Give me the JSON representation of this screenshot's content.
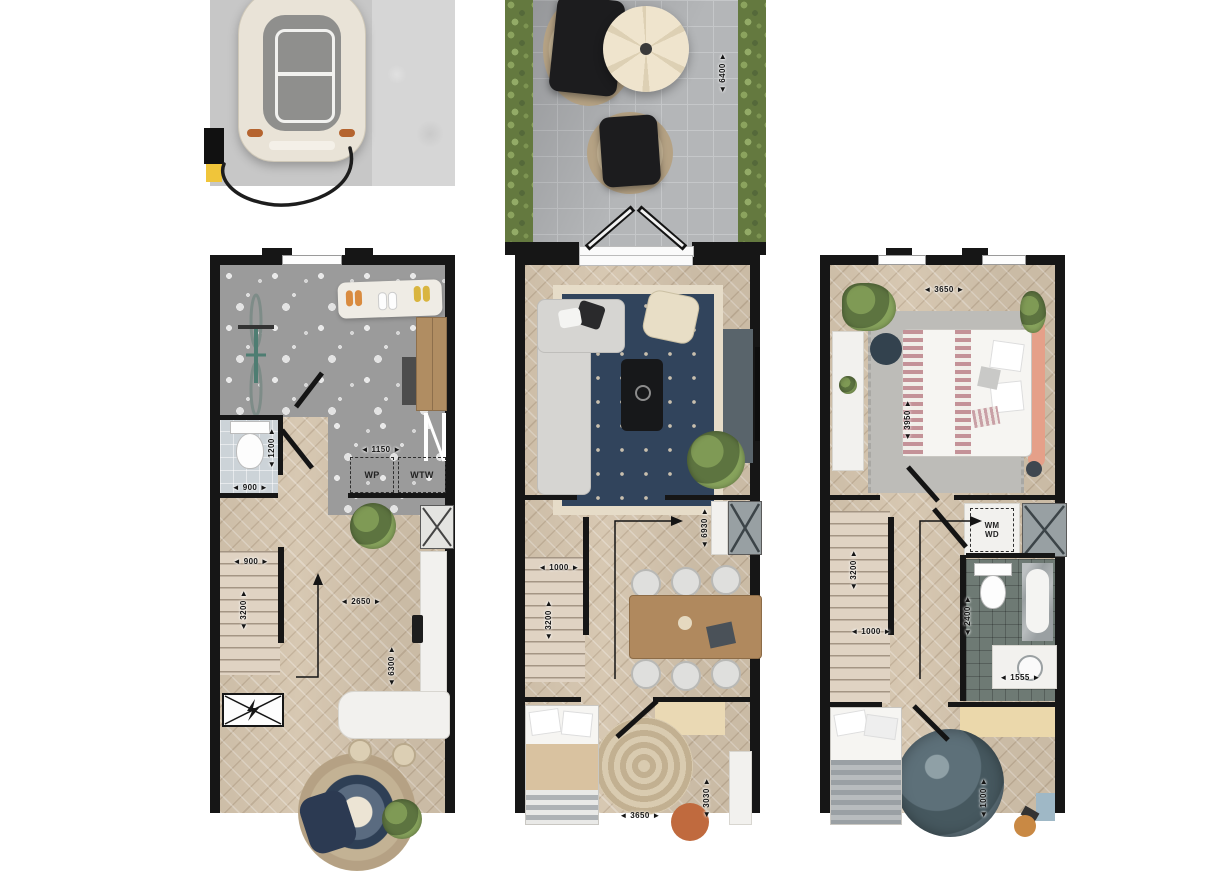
{
  "palette": {
    "wall": "#161616",
    "wood_floor": "#d5c5ae",
    "terrazzo_floor": "#9b9b9b",
    "terrace_tile": "#b4b6b8",
    "hedge_green": "#64793f",
    "wc_tile": "#ccd3d8",
    "bath_tile": "#6e7a74",
    "rug_navy": "#31445c",
    "rug_border_cream": "#e6dcc8",
    "headboard_salmon": "#e5a089",
    "moon_rug_blue": "#5d7079",
    "charger_yellow": "#f0c53a",
    "dining_table_wood": "#b0895e"
  },
  "terrace": {
    "dim_depth": "◄ 6400 ►"
  },
  "ground_floor": {
    "dims": {
      "wc_depth": "◄ 1200 ►",
      "wc_width": "◄ 900 ►",
      "appliances_width": "◄ 1150 ►",
      "stair_width": "◄ 900 ►",
      "stair_depth": "◄ 3200 ►",
      "hall_width": "◄ 2650 ►",
      "kitchen_depth": "◄ 6300 ►"
    },
    "labels": {
      "heat_pump": "WP",
      "heat_recovery": "WTW"
    }
  },
  "first_floor": {
    "dims": {
      "room_depth": "◄ 6930 ►",
      "stair_width": "◄ 1000 ►",
      "stair_depth": "◄ 3200 ►",
      "bedroom_width": "◄ 3650 ►",
      "bedroom_depth": "◄ 3030 ►"
    }
  },
  "second_floor": {
    "dims": {
      "bedroom_width": "◄ 3650 ►",
      "bedroom_depth": "◄ 3950 ►",
      "stair_depth": "◄ 3200 ►",
      "stair_width": "◄ 1000 ►",
      "bath_depth": "◄ 2400 ►",
      "bath_width": "◄ 1555 ►",
      "bottom_depth": "◄ 1000 ►"
    },
    "labels": {
      "washer": "WM",
      "dryer": "WD"
    }
  }
}
